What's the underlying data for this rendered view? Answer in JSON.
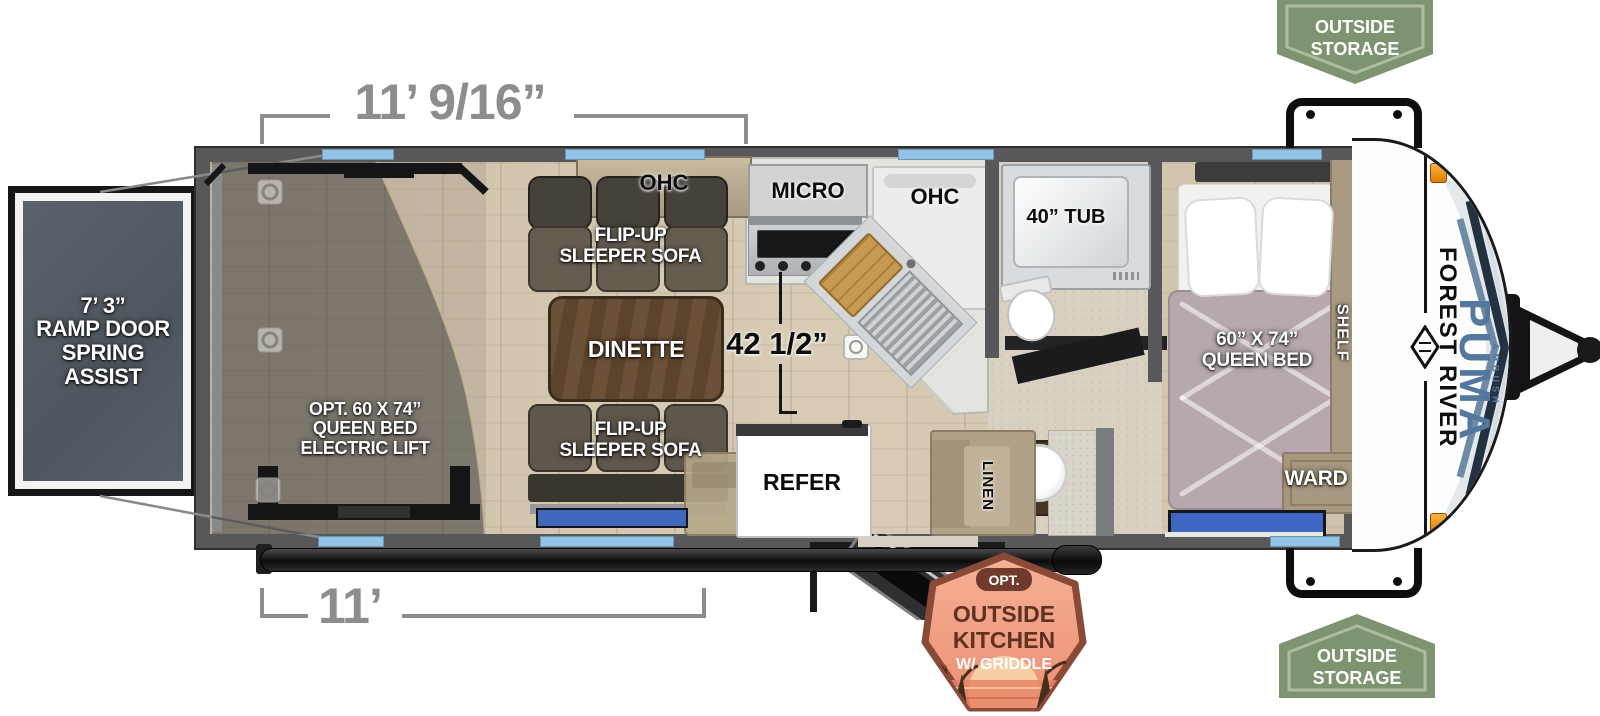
{
  "dimensions": {
    "top_width": "11’ 9/16”",
    "bottom_width": "11’",
    "kitchen_height": "42 1/2”"
  },
  "ramp_label": {
    "line1": "7’ 3”",
    "line2": "RAMP DOOR",
    "line3": "SPRING",
    "line4": "ASSIST"
  },
  "garage_label": {
    "line1": "OPT. 60 X 74”",
    "line2": "QUEEN BED",
    "line3": "ELECTRIC LIFT"
  },
  "sofas": {
    "top": {
      "line1": "FLIP-UP",
      "line2": "SLEEPER SOFA"
    },
    "bottom": {
      "line1": "FLIP-UP",
      "line2": "SLEEPER SOFA"
    }
  },
  "dinette_label": "DINETTE",
  "kitchen": {
    "ohc_left": "OHC",
    "micro": "MICRO",
    "ohc_right": "OHC",
    "refer": "REFER"
  },
  "bath": {
    "tub": "40” TUB",
    "linen": "LINEN"
  },
  "bedroom": {
    "bed_line1": "60” X 74”",
    "bed_line2": "QUEEN BED",
    "shelf": "SHELF",
    "ward": "WARD"
  },
  "badges": {
    "storage_top": {
      "line1": "OUTSIDE",
      "line2": "STORAGE"
    },
    "storage_bottom": {
      "line1": "OUTSIDE",
      "line2": "STORAGE"
    },
    "outside_kitchen": {
      "opt": "OPT.",
      "line1": "OUTSIDE",
      "line2": "KITCHEN",
      "line3": "W/ GRIDDLE"
    }
  },
  "branding": {
    "manufacturer": "FOREST RIVER",
    "model": "PUMA",
    "series": "AMBUSH"
  },
  "colors": {
    "badge_green": "#7e9370",
    "badge_green_inner": "#aebc9c",
    "kitchen_badge_fill": "#f0a183",
    "kitchen_badge_border": "#8a4a38",
    "window_blue": "#93c4e8",
    "brand_blue": "#54779e",
    "dim_gray": "#8d8d8d",
    "wall_gray": "#58585a"
  }
}
